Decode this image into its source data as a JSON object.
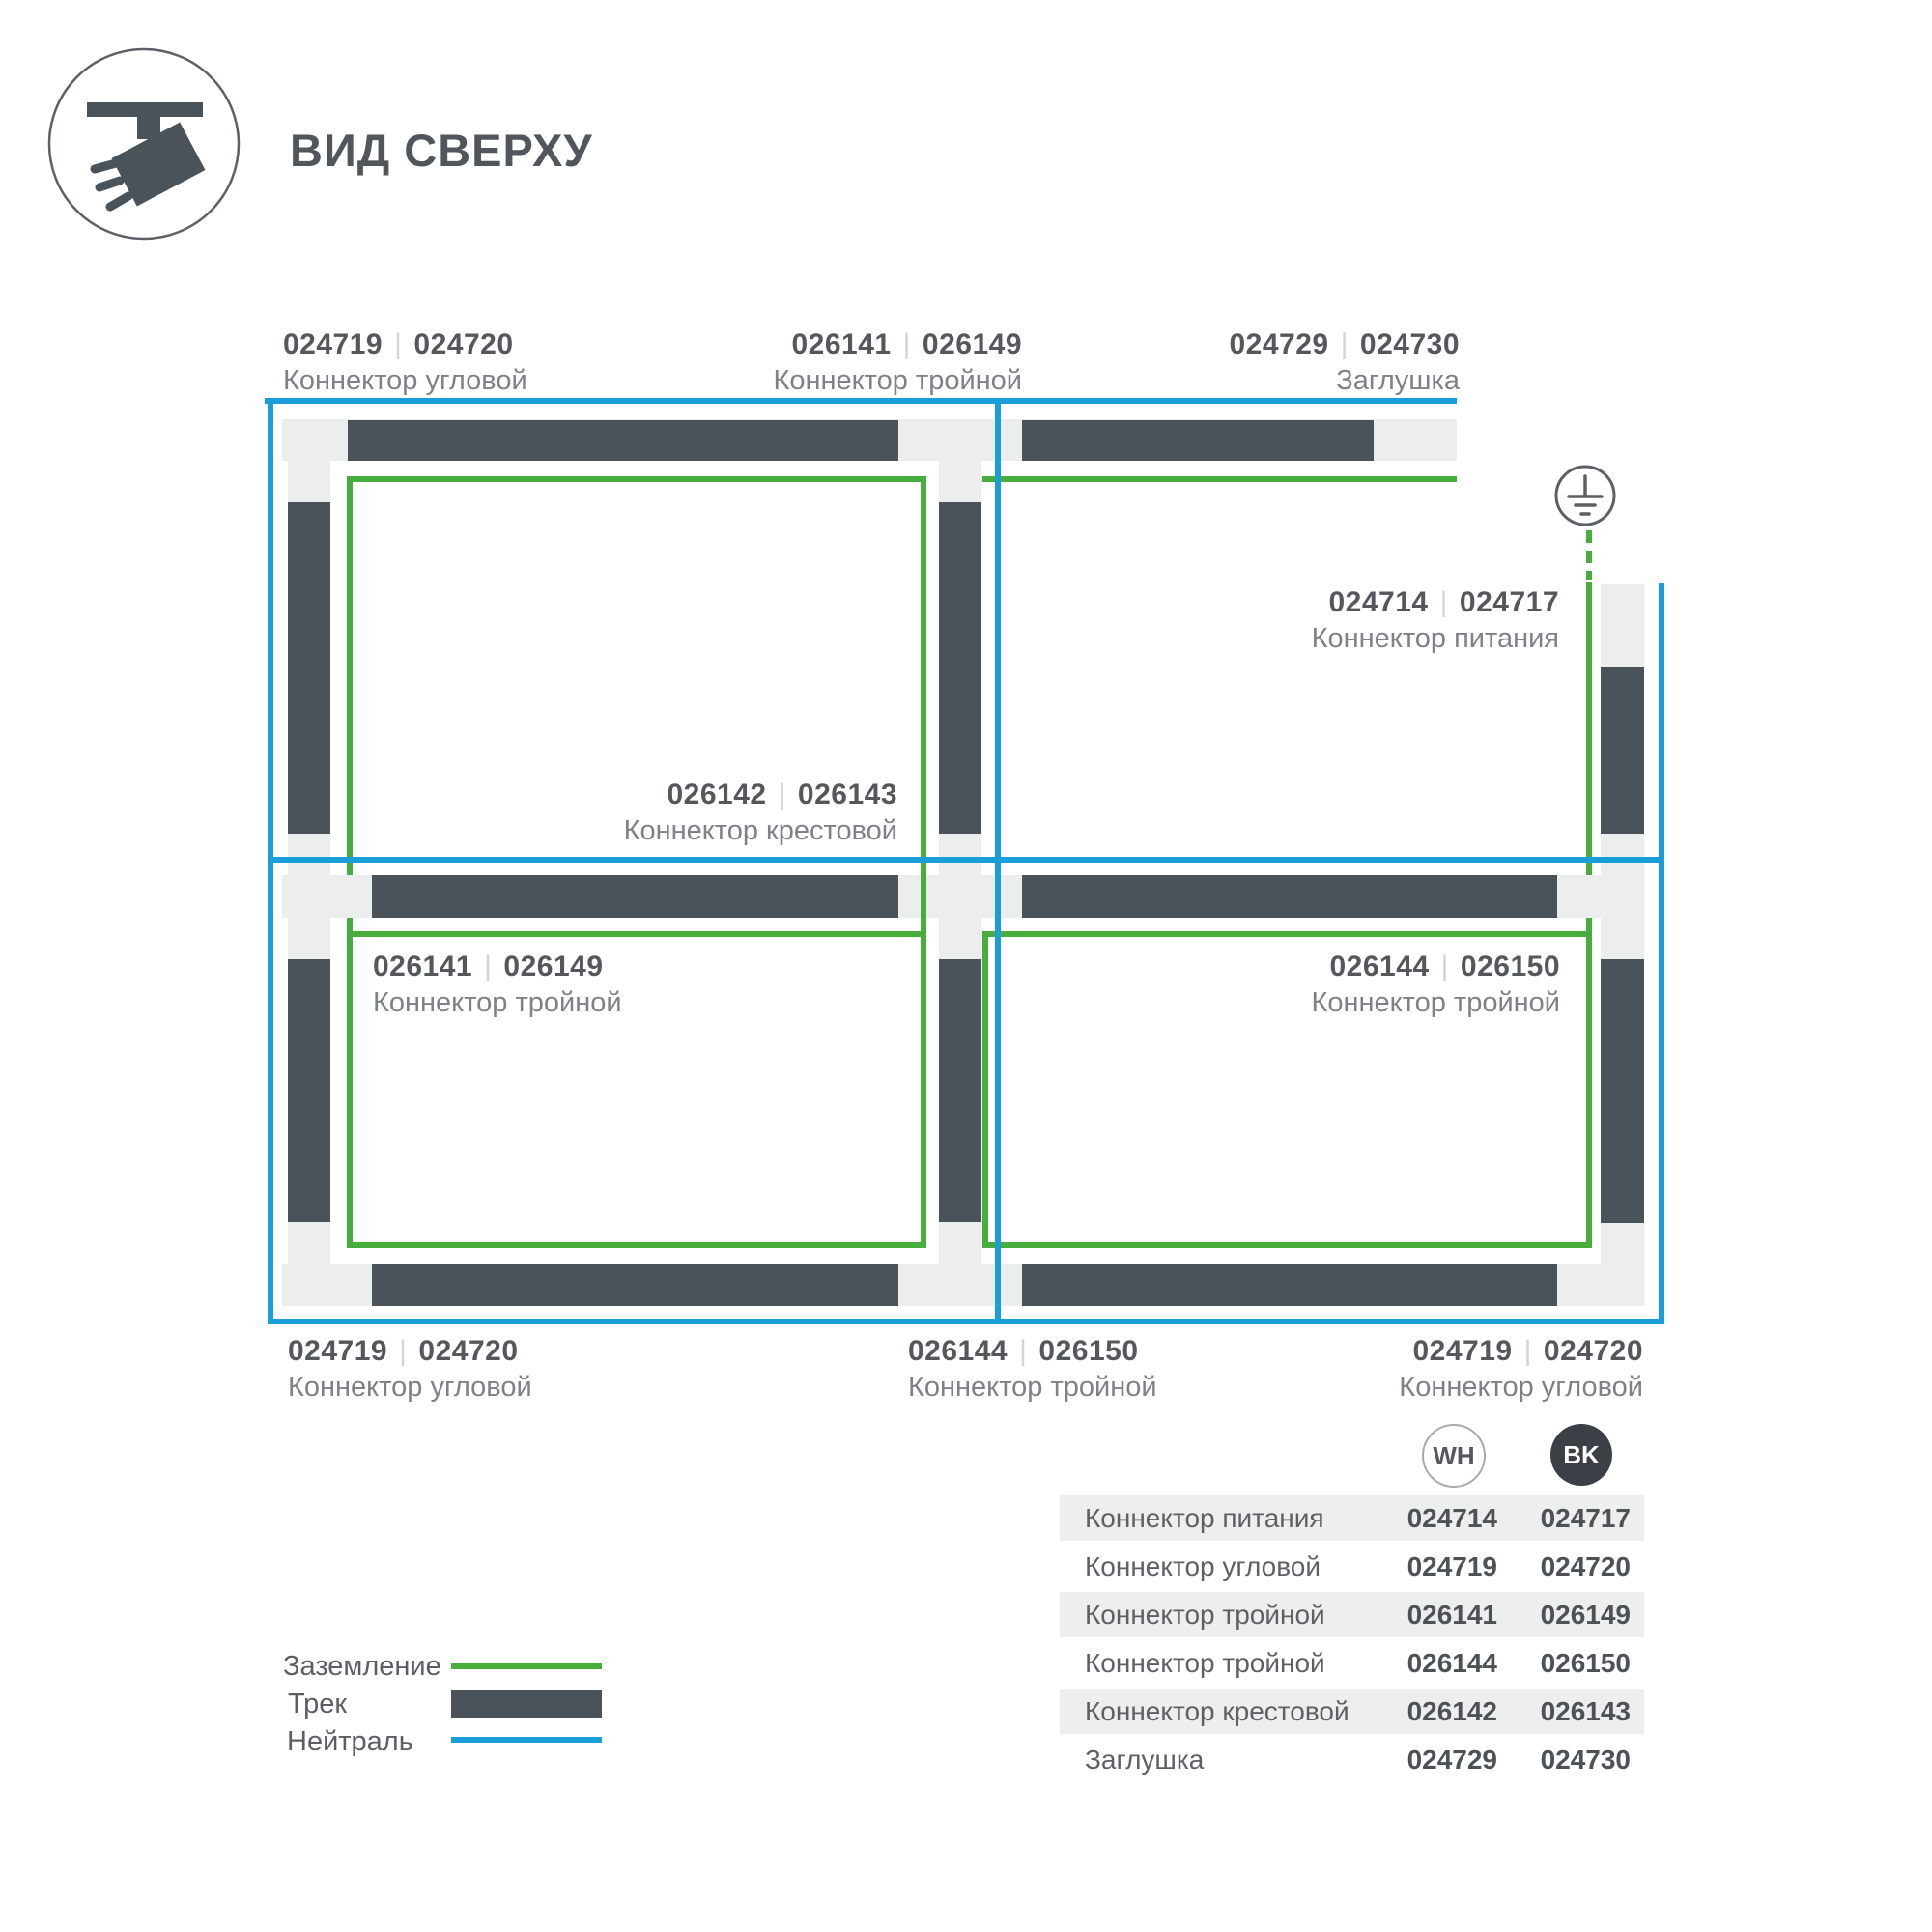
{
  "header": {
    "title": "ВИД СВЕРХУ"
  },
  "sep": "|",
  "diagram": {
    "labels": [
      {
        "wh": "024719",
        "bk": "024720",
        "name": "Коннектор угловой"
      },
      {
        "wh": "026141",
        "bk": "026149",
        "name": "Коннектор тройной"
      },
      {
        "wh": "024729",
        "bk": "024730",
        "name": "Заглушка"
      },
      {
        "wh": "024714",
        "bk": "024717",
        "name": "Коннектор питания"
      },
      {
        "wh": "026142",
        "bk": "026143",
        "name": "Коннектор крестовой"
      },
      {
        "wh": "026141",
        "bk": "026149",
        "name": "Коннектор тройной"
      },
      {
        "wh": "026144",
        "bk": "026150",
        "name": "Коннектор тройной"
      },
      {
        "wh": "024719",
        "bk": "024720",
        "name": "Коннектор угловой"
      },
      {
        "wh": "026144",
        "bk": "026150",
        "name": "Коннектор тройной"
      },
      {
        "wh": "024719",
        "bk": "024720",
        "name": "Коннектор угловой"
      }
    ]
  },
  "legend": {
    "items": [
      {
        "label": "Заземление"
      },
      {
        "label": "Трек"
      },
      {
        "label": "Нейтраль"
      }
    ]
  },
  "table": {
    "columns": [
      {
        "code": "WH"
      },
      {
        "code": "BK"
      }
    ],
    "rows": [
      {
        "name": "Коннектор питания",
        "wh": "024714",
        "bk": "024717"
      },
      {
        "name": "Коннектор угловой",
        "wh": "024719",
        "bk": "024720"
      },
      {
        "name": "Коннектор тройной",
        "wh": "026141",
        "bk": "026149"
      },
      {
        "name": "Коннектор тройной",
        "wh": "026144",
        "bk": "026150"
      },
      {
        "name": "Коннектор крестовой",
        "wh": "026142",
        "bk": "026143"
      },
      {
        "name": "Заглушка",
        "wh": "024729",
        "bk": "024730"
      }
    ]
  },
  "colors": {
    "track": "#4A525A",
    "connector": "#ECEDED",
    "ground": "#47AE3E",
    "neutral": "#1A9EDA",
    "badge_bk": "#3B4046",
    "text_primary": "#54585D",
    "text_secondary": "#7E8287"
  }
}
